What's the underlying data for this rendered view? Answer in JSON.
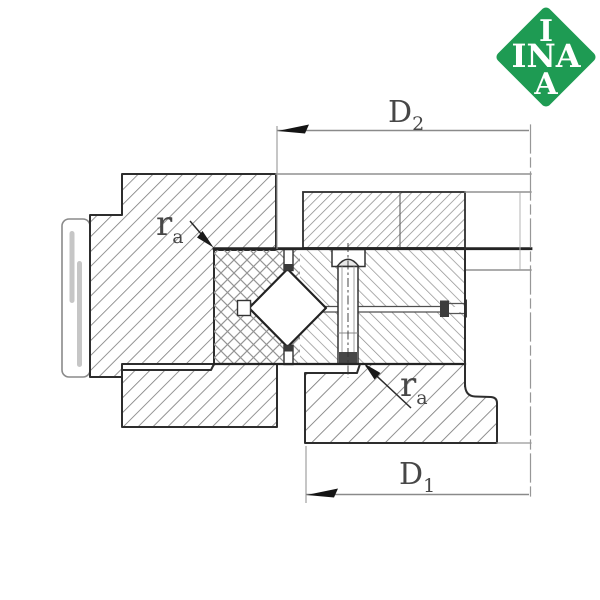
{
  "brand_logo": {
    "top": "I",
    "middle": "INA",
    "bottom": "A",
    "background_color": "#1e9b53",
    "text_color": "#ffffff"
  },
  "dimension_labels": {
    "d2": {
      "main": "D",
      "sub": "2"
    },
    "d1": {
      "main": "D",
      "sub": "1"
    },
    "ra_top": {
      "main": "r",
      "sub": "a"
    },
    "ra_bottom": {
      "main": "r",
      "sub": "a"
    }
  },
  "colors": {
    "outline": "#2d2d2d",
    "hatch": "#7a7a7a",
    "dimension_line": "#8a8a8a",
    "arrow": "#141414"
  }
}
